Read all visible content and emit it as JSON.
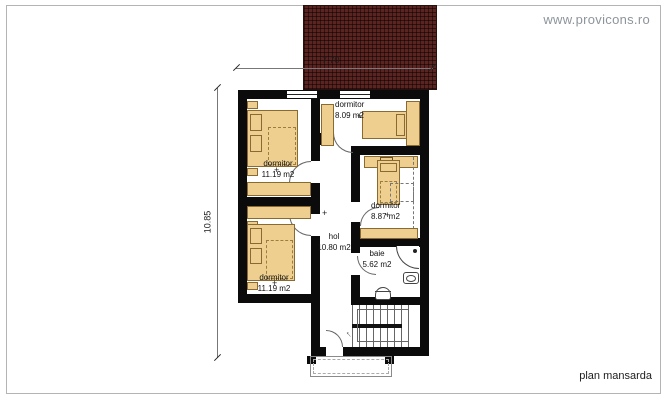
{
  "header": {
    "watermark": "www.provicons.ro"
  },
  "footer": {
    "plan_label": "plan mansarda"
  },
  "dimensions": {
    "width": "7.70",
    "height": "10.85"
  },
  "rooms": {
    "dormitor_tl": {
      "name": "dormitor",
      "area": "11.19 m2"
    },
    "dormitor_bl": {
      "name": "dormitor",
      "area": "11.19 m2"
    },
    "dormitor_tr": {
      "name": "dormitor",
      "area": "8.09 m2"
    },
    "dormitor_mr": {
      "name": "dormitor",
      "area": "8.87 m2"
    },
    "hol": {
      "name": "hol",
      "area": "10.80 m2"
    },
    "baie": {
      "name": "baie",
      "area": "5.62 m2"
    }
  },
  "symbols": {
    "center_mark": "+",
    "stair_arrow": "↑"
  },
  "colors": {
    "wall": "#0b0b0b",
    "furniture": "#eecf8f",
    "furniture_outline": "#8a6a33",
    "roof": "#5b2420",
    "watermark": "#8d949b",
    "dimension_text": "#1a1a1a"
  }
}
